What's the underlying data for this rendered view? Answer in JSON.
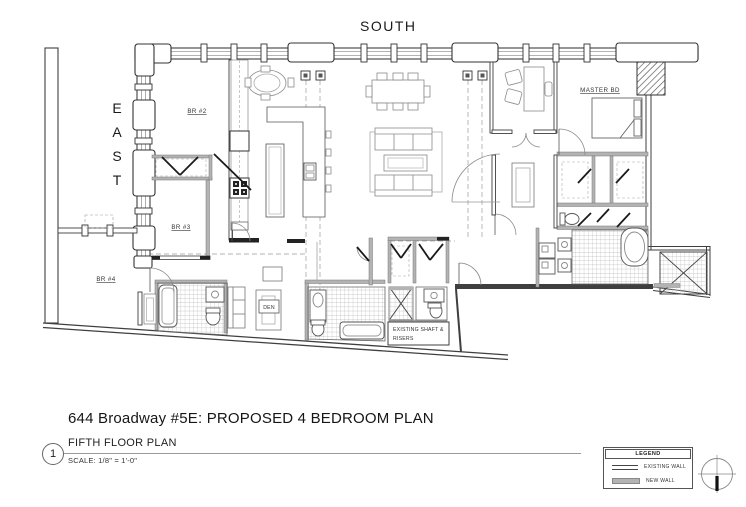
{
  "plan": {
    "orientation": {
      "south": "SOUTH",
      "east": "EAST"
    },
    "rooms": {
      "br2": "BR #2",
      "br3": "BR #3",
      "br4": "BR #4",
      "master_bedroom": "MASTER BD",
      "den": "DEN",
      "shaft_line1": "EXISTING SHAFT &",
      "shaft_line2": "RISERS"
    }
  },
  "title_block": {
    "drawing_number": "1",
    "title": "644 Broadway #5E: PROPOSED 4 BEDROOM PLAN",
    "drawing_name": "FIFTH FLOOR PLAN",
    "scale_note": "SCALE: 1/8\" = 1'-0\""
  },
  "legend": {
    "title": "LEGEND",
    "items": [
      {
        "label": "EXISTING WALL",
        "symbol": "double-thin-line"
      },
      {
        "label": "NEW WALL",
        "symbol": "thick-gray-bar"
      }
    ]
  },
  "colors": {
    "existing_wall_line": "#3f3f3f",
    "new_wall_fill": "#b3b3b3",
    "tile_line": "#b8b8b8",
    "paper": "#ffffff"
  }
}
